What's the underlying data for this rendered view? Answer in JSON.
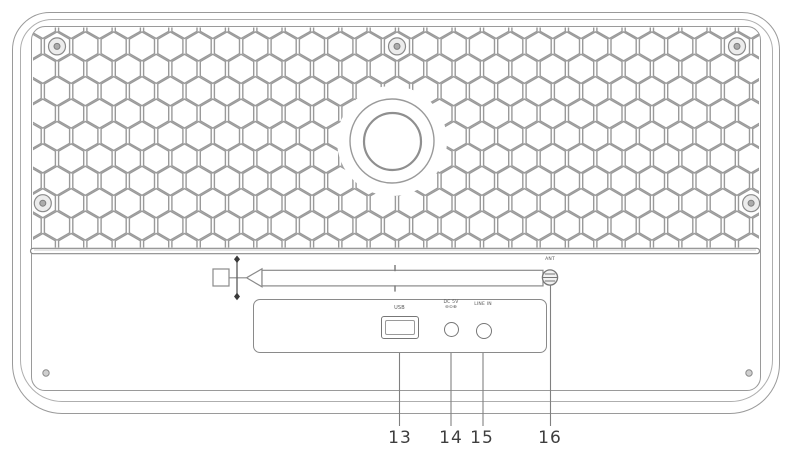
{
  "device": {
    "labels": {
      "antenna": "ANT",
      "usb_port": "USB",
      "dc_in_line1": "DC 5V",
      "dc_in_line2": "⊖⊙⊕",
      "line_in": "LINE IN"
    },
    "callouts": {
      "usb": "13",
      "dc_in": "14",
      "line_in": "15",
      "antenna": "16"
    },
    "colors": {
      "line": "#9a9a9a",
      "line_dark": "#777777",
      "callout_text": "#3e3e3e",
      "background": "#ffffff"
    }
  }
}
